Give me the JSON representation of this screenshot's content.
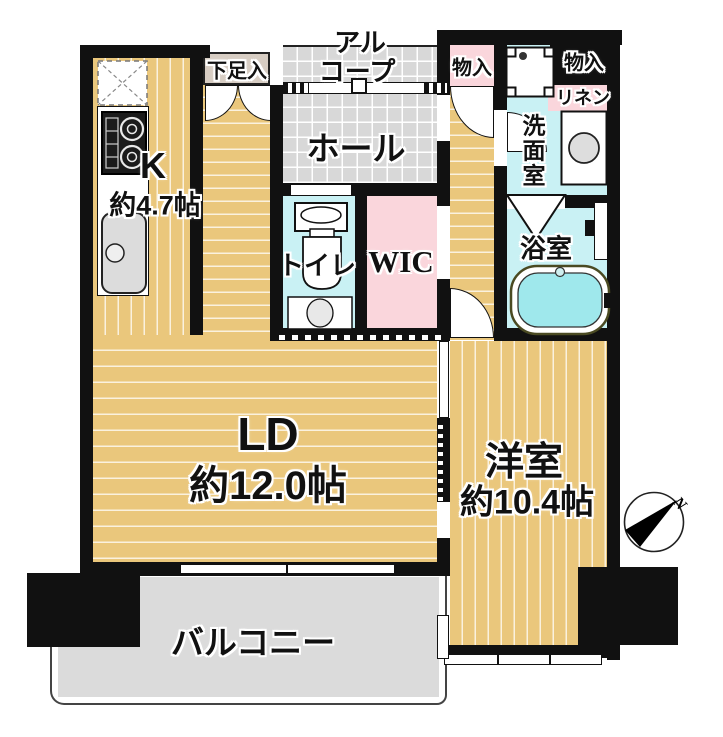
{
  "rooms": {
    "kitchen": {
      "label": "K",
      "size": "約4.7帖"
    },
    "living_dining": {
      "label": "LD",
      "size": "約12.0帖"
    },
    "western_room": {
      "label": "洋室",
      "size": "約10.4帖"
    },
    "hall": {
      "label": "ホール"
    },
    "alcove": {
      "line1": "アル",
      "line2": "コープ"
    },
    "shoe_storage": {
      "label": "下足入"
    },
    "hall_storage": {
      "label": "物入"
    },
    "top_storage": {
      "label": "物入"
    },
    "linen": {
      "label": "リネン"
    },
    "washroom": {
      "label": "洗面室"
    },
    "bathroom": {
      "label": "浴室"
    },
    "toilet": {
      "label": "トイレ"
    },
    "wic": {
      "label": "WIC"
    },
    "balcony": {
      "label": "バルコニー"
    }
  },
  "compass": {
    "north_label": "N"
  },
  "colors": {
    "wall": "#111111",
    "wood_floor": "#EAC77C",
    "tile_floor": "#D8D8D8",
    "wet_area": "#C9F1F4",
    "closet_pink": "#FAD6DC",
    "shoe_beige": "#D7CDC3",
    "balcony_gray": "#DBDBDB",
    "bath_water": "#9FE8EC"
  }
}
